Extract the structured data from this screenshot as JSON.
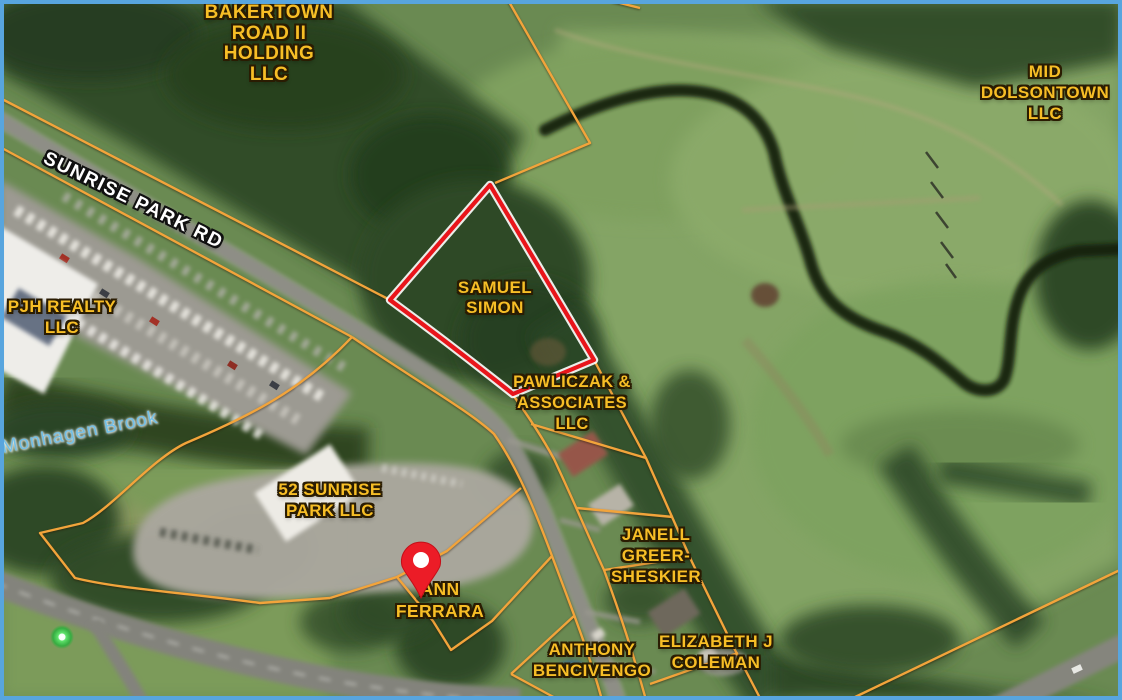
{
  "map": {
    "type": "satellite-parcel-view",
    "frame_border_color": "#58a5de",
    "colors": {
      "parcel_line": "#f2a43b",
      "highlight_outline": "#e9151b",
      "highlight_halo": "#ffffff",
      "owner_label": "#f7be26",
      "owner_label_outline": "#2a1c02",
      "road_label": "#ffffff",
      "water_label": "#72bfe6",
      "pin": "#ec1c27",
      "street_dot": "#3fd34a"
    },
    "owner_labels": [
      {
        "id": "bakertown-road-ii-holding-llc",
        "lines": [
          "BAKERTOWN",
          "ROAD II",
          "HOLDING",
          "LLC"
        ],
        "x": 269,
        "y": 3,
        "size": 19,
        "lh": 20.5
      },
      {
        "id": "mid-dolsontown-llc",
        "lines": [
          "MID",
          "DOLSONTOWN",
          "LLC"
        ],
        "x": 1045,
        "y": 61,
        "size": 17,
        "lh": 21
      },
      {
        "id": "pjh-realty-llc",
        "lines": [
          "PJH REALTY",
          "LLC"
        ],
        "x": 62,
        "y": 297,
        "size": 17,
        "lh": 20.5
      },
      {
        "id": "samuel-simon",
        "lines": [
          "SAMUEL",
          "SIMON"
        ],
        "x": 495,
        "y": 278,
        "size": 17,
        "lh": 20
      },
      {
        "id": "pawliczak-associates-llc",
        "lines": [
          "PAWLICZAK &",
          "ASSOCIATES",
          "LLC"
        ],
        "x": 572,
        "y": 372,
        "size": 16.5,
        "lh": 21
      },
      {
        "id": "52-sunrise-park-llc",
        "lines": [
          "52 SUNRISE",
          "PARK LLC"
        ],
        "x": 330,
        "y": 480,
        "size": 17,
        "lh": 20.5
      },
      {
        "id": "ann-ferrara",
        "lines": [
          "ANN",
          "FERRARA"
        ],
        "x": 440,
        "y": 578,
        "size": 17.5,
        "lh": 22
      },
      {
        "id": "janell-greer-sheskier",
        "lines": [
          "JANELL",
          "GREER-",
          "SHESKIER"
        ],
        "x": 656,
        "y": 524,
        "size": 17,
        "lh": 21
      },
      {
        "id": "anthony-bencivengo",
        "lines": [
          "ANTHONY",
          "BENCIVENGO"
        ],
        "x": 592,
        "y": 639,
        "size": 17,
        "lh": 21
      },
      {
        "id": "elizabeth-j-coleman",
        "lines": [
          "ELIZABETH J",
          "COLEMAN"
        ],
        "x": 716,
        "y": 631,
        "size": 17,
        "lh": 21
      }
    ],
    "road_label": {
      "text": "SUNRISE PARK RD",
      "x": 133,
      "y": 201,
      "rotation": 26
    },
    "water_label": {
      "text": "Monhagen Brook",
      "x": 80,
      "y": 433,
      "rotation": -11
    },
    "highlighted_parcel": {
      "owner": "SAMUEL SIMON",
      "outline_color": "#e9151b"
    },
    "marker": {
      "type": "map-pin",
      "x": 421,
      "y": 598,
      "parcel": "ann-ferrara"
    },
    "street_view_dot": {
      "x": 62,
      "y": 637
    }
  }
}
